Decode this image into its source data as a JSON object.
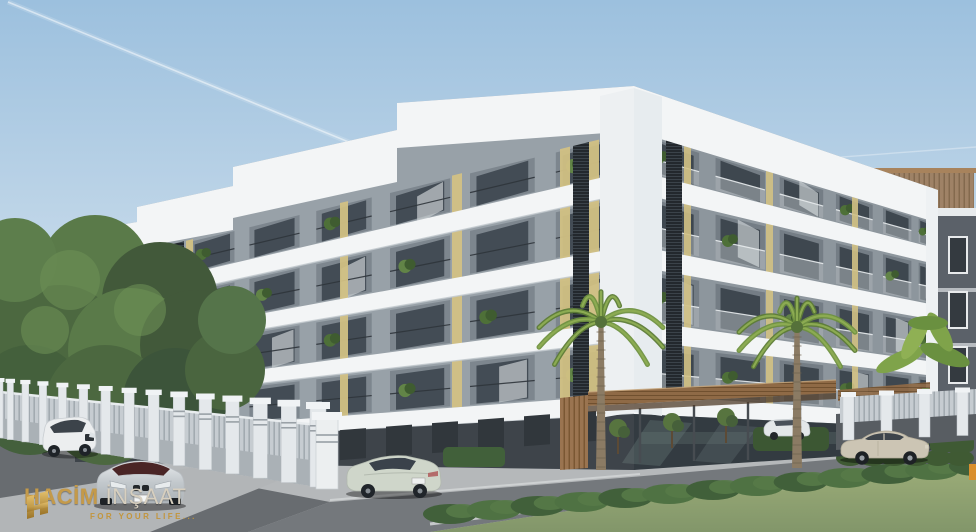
{
  "window": {
    "width": 976,
    "height": 532
  },
  "scene": {
    "kind": "3D architectural rendering of a residential project",
    "subject": "Modern five-storey apartment block with stepped white slab facade, grey walls, yellow accent strips, dark louver columns, balconies with plants, glass ground floor with wooden entrance canopy",
    "sky": "clear blue sky with two jet contrails",
    "surroundings": [
      "hazy hills",
      "large green tree",
      "two tall palm trees",
      "banana plant",
      "hedges and lawn",
      "perimeter fence with ornamental white pillars",
      "dark grey neighbouring building with wooden pergola"
    ],
    "vehicles": [
      "white SUV front view",
      "silver coupe front view",
      "pale green sedan rear view",
      "beige sedan side view",
      "white car behind hedge"
    ]
  },
  "branding": {
    "name": "HACİM",
    "suffix": "İNŞAAT",
    "tagline": "FOR YOUR LIFE...",
    "icon": "gold-brick-monogram-icon"
  },
  "palette": {
    "sky_top": "#9cc0de",
    "sky_bottom": "#eaf1f6",
    "building_white": "#f3f5f6",
    "wall_grey": "#98a1a8",
    "wall_grey_dark": "#8d969d",
    "accent_yellow": "#d2c184",
    "window_glass": "#434c55",
    "louver_dark": "#23282d",
    "wood": "#8f6a46",
    "fence_light": "#e4e8eb",
    "asphalt": "#686c70",
    "concrete": "#b5b8ba",
    "grass": "#96a575",
    "hedge_green": "#41603a",
    "bg_building": "#5b6169",
    "logo_gold": "#c49a4a",
    "logo_gold2": "#c2953c",
    "logo_light": "#d7cfbf"
  }
}
